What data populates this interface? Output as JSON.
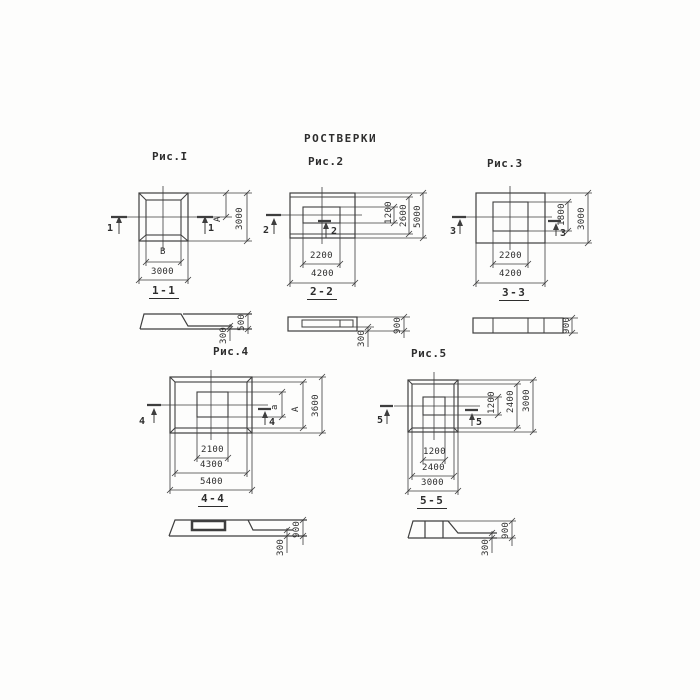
{
  "title": "РОСТВЕРКИ",
  "colors": {
    "line": "#3e3e3e",
    "background": "#fdfdfc",
    "text": "#2d2d2d"
  },
  "fig1": {
    "label": "Рис.I",
    "marker": "1",
    "plan_dims": {
      "vert_inner": "A",
      "vert_outer": "3000",
      "horiz_inner": "В",
      "horiz_outer": "3000"
    },
    "section_title": "1-1",
    "section_dims": {
      "inner": "300",
      "outer": "500"
    }
  },
  "fig2": {
    "label": "Рис.2",
    "marker": "2",
    "plan_dims": {
      "vert_inner": "1200",
      "vert_mid": "2600",
      "vert_outer": "5000",
      "horiz_inner": "2200",
      "horiz_outer": "4200"
    },
    "section_title": "2-2",
    "section_dims": {
      "inner": "300",
      "outer": "900"
    }
  },
  "fig3": {
    "label": "Рис.3",
    "marker": "3",
    "plan_dims": {
      "vert_inner": "1800",
      "vert_outer": "3000",
      "horiz_inner": "2200",
      "horiz_outer": "4200"
    },
    "section_title": "3-3",
    "section_dims": {
      "outer": "900"
    }
  },
  "fig4": {
    "label": "Рис.4",
    "marker": "4",
    "plan_dims": {
      "vert_inner": "а",
      "vert_mid": "A",
      "vert_outer": "3600",
      "horiz_inner": "2100",
      "horiz_mid": "4300",
      "horiz_outer": "5400"
    },
    "section_title": "4-4",
    "section_dims": {
      "inner": "300",
      "outer": "900"
    }
  },
  "fig5": {
    "label": "Рис.5",
    "marker": "5",
    "plan_dims": {
      "vert_inner": "1200",
      "vert_mid": "2400",
      "vert_outer": "3000",
      "horiz_inner": "1200",
      "horiz_mid": "2400",
      "horiz_outer": "3000"
    },
    "section_title": "5-5",
    "section_dims": {
      "inner": "300",
      "outer": "900"
    }
  }
}
